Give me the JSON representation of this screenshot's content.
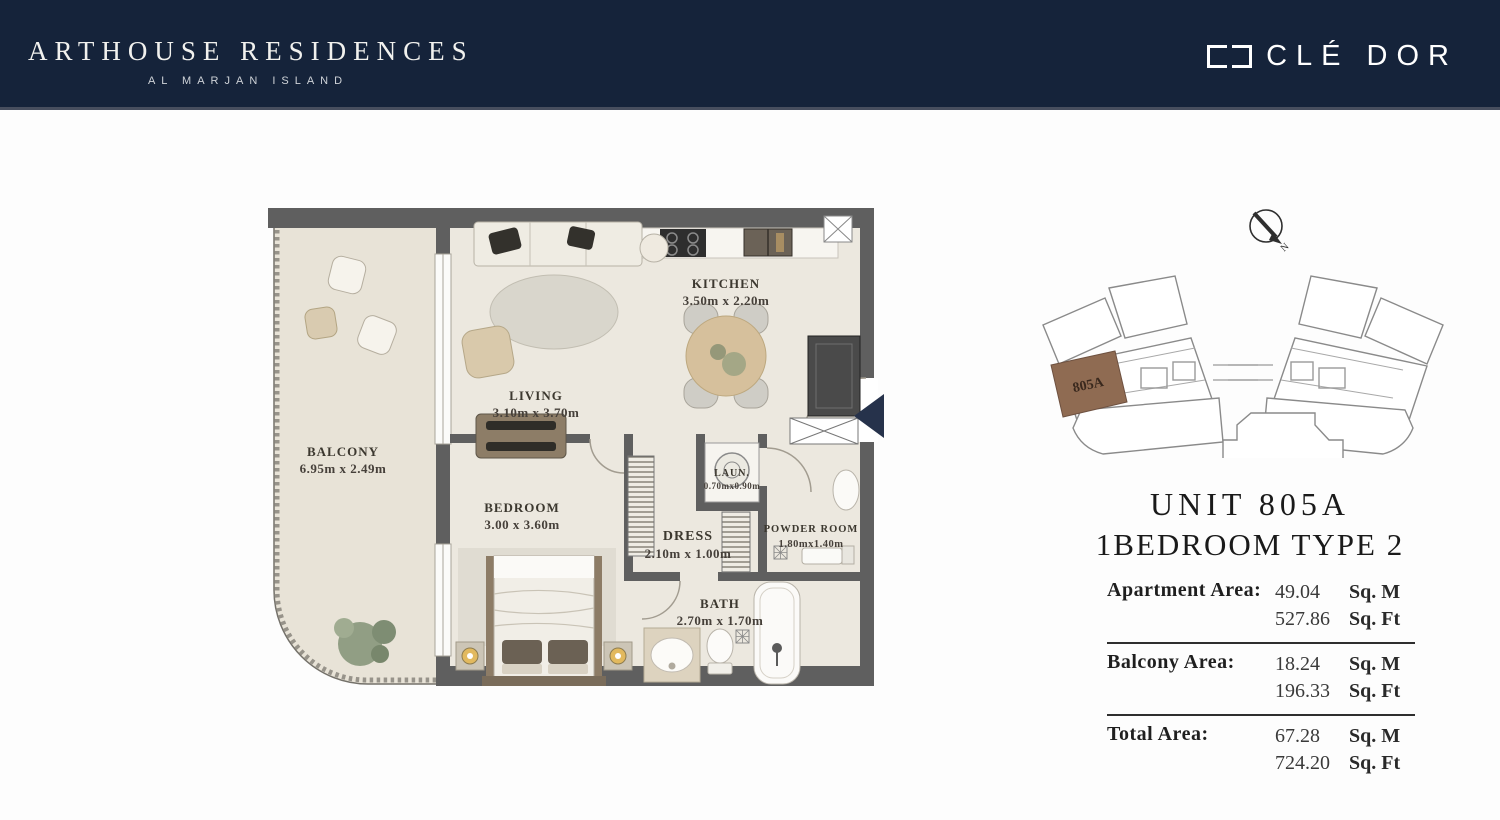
{
  "header": {
    "brand": "ARTHOUSE RESIDENCES",
    "sub_brand": "AL MARJAN ISLAND",
    "logo_text": "CLÉ DOR"
  },
  "floor_plan": {
    "rooms": {
      "balcony": {
        "name": "BALCONY",
        "dims": "6.95m x 2.49m"
      },
      "living": {
        "name": "LIVING",
        "dims": "3.10m x 3.70m"
      },
      "kitchen": {
        "name": "KITCHEN",
        "dims": "3.50m x 2.20m"
      },
      "bedroom": {
        "name": "BEDROOM",
        "dims": "3.00 x 3.60m"
      },
      "dress": {
        "name": "DRESS",
        "dims": "2.10m x 1.00m"
      },
      "laundry": {
        "name": "LAUN.",
        "dims": "0.70mx0.90m"
      },
      "powder": {
        "name": "POWDER ROOM",
        "dims": "1.80mx1.40m"
      },
      "bath": {
        "name": "BATH",
        "dims": "2.70m x 1.70m"
      }
    }
  },
  "key_plan": {
    "highlight_label": "805A",
    "highlight_color": "#8f6b52",
    "compass_label": "N"
  },
  "unit_info": {
    "title_line1": "UNIT 805A",
    "title_line2": "1BEDROOM TYPE 2"
  },
  "areas": {
    "rows": [
      {
        "label": "Apartment Area:",
        "sqm": "49.04",
        "sqm_unit": "Sq. M",
        "sqft": "527.86",
        "sqft_unit": "Sq. Ft"
      },
      {
        "label": "Balcony Area:",
        "sqm": "18.24",
        "sqm_unit": "Sq. M",
        "sqft": "196.33",
        "sqft_unit": "Sq. Ft"
      },
      {
        "label": "Total Area:",
        "sqm": "67.28",
        "sqm_unit": "Sq. M",
        "sqft": "724.20",
        "sqft_unit": "Sq. Ft"
      }
    ]
  },
  "colors": {
    "header_navy": "#15233a",
    "wall_gray": "#5f5f5f",
    "floor_beige": "#ece8df",
    "balcony_beige": "#e8e3d7",
    "entry_arrow_navy": "#26324b"
  }
}
